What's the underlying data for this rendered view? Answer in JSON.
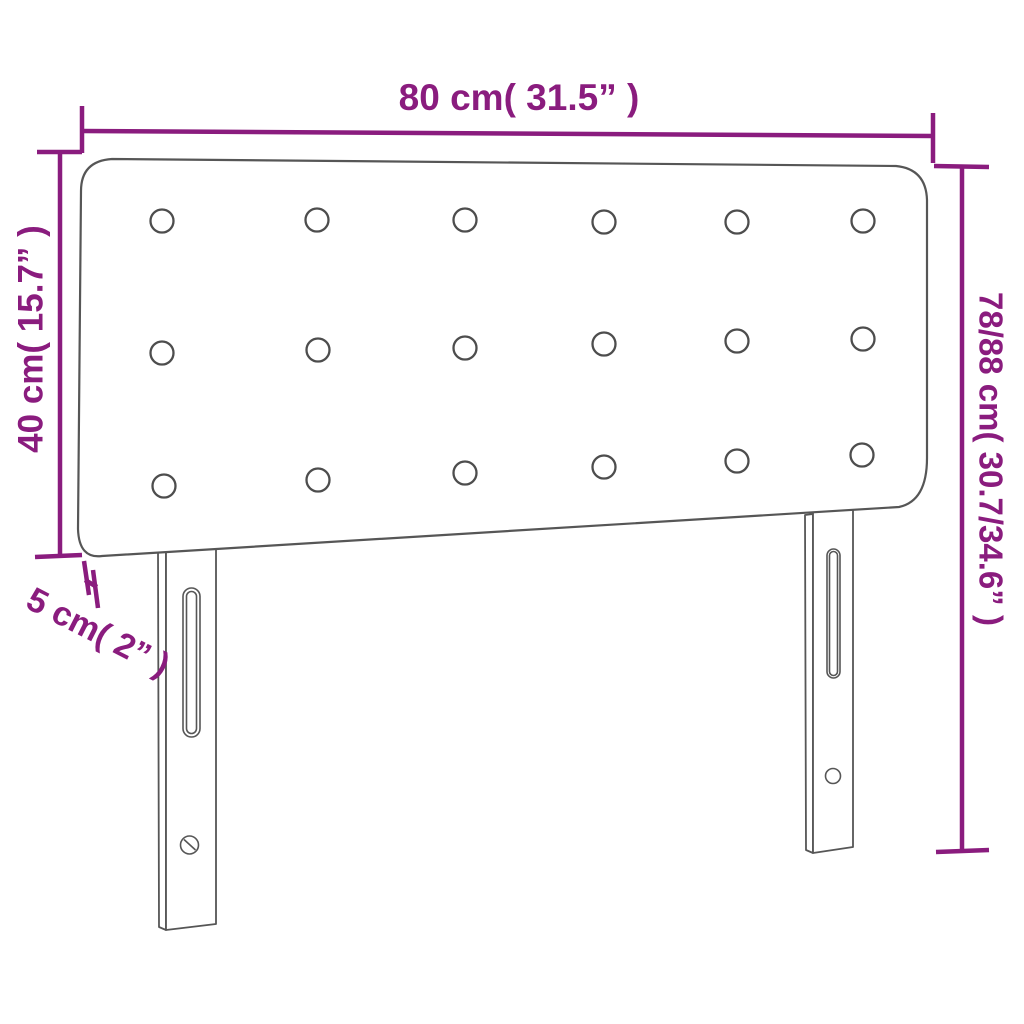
{
  "diagram": {
    "colors": {
      "dimension": "#8a1c7e",
      "outline": "#565656",
      "background": "#ffffff"
    },
    "dimensions": {
      "width": {
        "label": "80 cm( 31.5” )"
      },
      "panel_height": {
        "label": "40 cm( 15.7” )"
      },
      "total_height": {
        "label": "78/88 cm( 30.7/34.6” )"
      },
      "depth": {
        "label": "5 cm( 2” )"
      }
    },
    "tuft_buttons": {
      "rows": 3,
      "columns": 6,
      "count": 18
    }
  }
}
